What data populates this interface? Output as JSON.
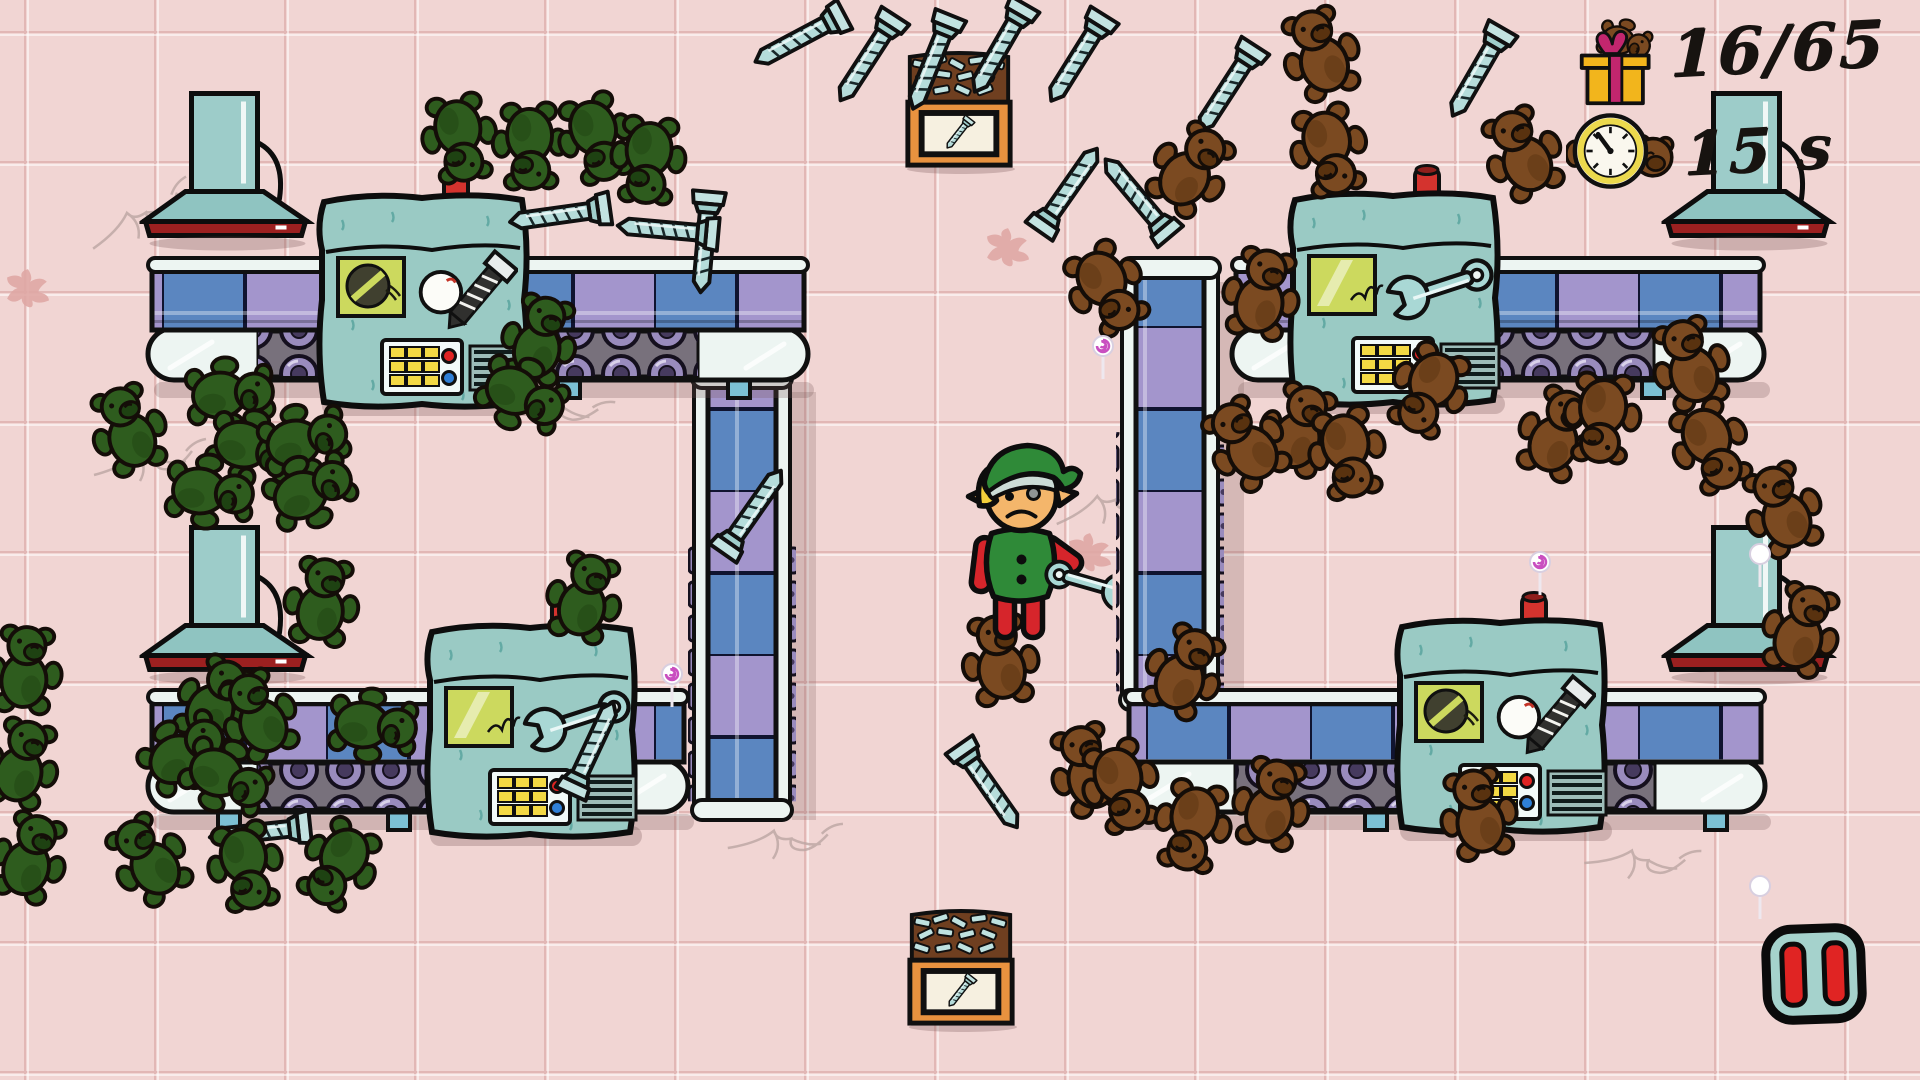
{
  "meta": {
    "screen_width": 1920,
    "screen_height": 1080,
    "scene": "toy-factory-level"
  },
  "hud": {
    "toys": {
      "icon": "gift-with-teddy",
      "counter": "16/65"
    },
    "timer": {
      "icon": "teddy-stopwatch",
      "value": "15 s"
    },
    "pause": {
      "kind": "pause-button"
    }
  },
  "colors": {
    "floor": "#f1d5d3",
    "floor_line": "#e2b7b5",
    "machine_teal": "#9acac4",
    "belt_blue": "#5b86c0",
    "belt_purple": "#a395cc",
    "frame_white": "#edf5f2",
    "roller_purple": "#998bbd",
    "roller_strip": "#78717c",
    "bear_brown": "#7b4a21",
    "bear_green": "#2e5c1e",
    "bolt_teal": "#b5dcda",
    "sign_yellow": "#ccd95e",
    "lever_red": "#d4332e",
    "pause_red": "#e02423",
    "bin_orange": "#e8923f",
    "hud_text": "#171310",
    "gift_yellow": "#f2b51c",
    "ribbon_magenta": "#c2266e",
    "watch_ring": "#ecd94d"
  },
  "entities": {
    "lamps": [
      [
        140,
        88
      ],
      [
        140,
        522
      ],
      [
        1662,
        88
      ],
      [
        1662,
        522
      ]
    ],
    "conveyors_v": [
      [
        694,
        378,
        432
      ],
      [
        1122,
        268,
        432
      ]
    ],
    "conveyors_h": [
      [
        148,
        266,
        660
      ],
      [
        1232,
        266,
        532
      ],
      [
        148,
        698,
        540
      ],
      [
        1125,
        698,
        640
      ]
    ],
    "machines": [
      [
        312,
        190,
        "screw"
      ],
      [
        1283,
        188,
        "wrench"
      ],
      [
        420,
        620,
        "wrench"
      ],
      [
        1390,
        615,
        "screw"
      ]
    ],
    "bins": [
      [
        900,
        48
      ],
      [
        902,
        906
      ]
    ],
    "elf": [
      1025,
      552
    ],
    "brown_bears": [
      [
        1320,
        52,
        -20
      ],
      [
        1330,
        152,
        165
      ],
      [
        1522,
        152,
        -25
      ],
      [
        1192,
        168,
        35
      ],
      [
        1108,
        290,
        150
      ],
      [
        1262,
        292,
        12
      ],
      [
        1690,
        362,
        -18
      ],
      [
        1428,
        392,
        -155
      ],
      [
        1300,
        428,
        18
      ],
      [
        1245,
        442,
        -35
      ],
      [
        1348,
        455,
        168
      ],
      [
        1558,
        432,
        22
      ],
      [
        1602,
        420,
        -175
      ],
      [
        1712,
        448,
        155
      ],
      [
        1782,
        508,
        -22
      ],
      [
        1802,
        628,
        18
      ],
      [
        1000,
        658,
        -8
      ],
      [
        1185,
        670,
        25
      ],
      [
        1088,
        768,
        -18
      ],
      [
        1122,
        788,
        162
      ],
      [
        1272,
        802,
        12
      ],
      [
        1192,
        828,
        -168
      ],
      [
        1478,
        812,
        -12
      ]
    ],
    "green_bears": [
      [
        460,
        140,
        170
      ],
      [
        530,
        148,
        178
      ],
      [
        597,
        140,
        162
      ],
      [
        648,
        162,
        185
      ],
      [
        540,
        338,
        15
      ],
      [
        524,
        396,
        115
      ],
      [
        128,
        428,
        -20
      ],
      [
        232,
        394,
        85
      ],
      [
        254,
        448,
        105
      ],
      [
        306,
        440,
        75
      ],
      [
        212,
        492,
        95
      ],
      [
        312,
        490,
        65
      ],
      [
        322,
        600,
        8
      ],
      [
        585,
        596,
        15
      ],
      [
        375,
        726,
        95
      ],
      [
        25,
        668,
        5
      ],
      [
        22,
        762,
        15
      ],
      [
        216,
        700,
        28
      ],
      [
        258,
        714,
        -25
      ],
      [
        186,
        752,
        55
      ],
      [
        228,
        778,
        115
      ],
      [
        30,
        856,
        18
      ],
      [
        148,
        858,
        -35
      ],
      [
        246,
        868,
        168
      ],
      [
        338,
        866,
        -150
      ]
    ],
    "bolts": [
      [
        800,
        38,
        62
      ],
      [
        868,
        58,
        33
      ],
      [
        932,
        62,
        22
      ],
      [
        1000,
        48,
        30
      ],
      [
        1078,
        58,
        32
      ],
      [
        1228,
        88,
        33
      ],
      [
        1478,
        72,
        30
      ],
      [
        560,
        215,
        82
      ],
      [
        705,
        242,
        5
      ],
      [
        668,
        230,
        95
      ],
      [
        1068,
        190,
        215
      ],
      [
        1138,
        198,
        140
      ],
      [
        752,
        512,
        215
      ],
      [
        592,
        748,
        205
      ],
      [
        260,
        832,
        84
      ],
      [
        988,
        786,
        325
      ]
    ],
    "swirls": [
      [
        1103,
        358,
        "#c94fc0"
      ],
      [
        672,
        686,
        "#c94fc0"
      ],
      [
        1540,
        574,
        "#c94fc0"
      ],
      [
        1760,
        566,
        "#ffffff"
      ],
      [
        1760,
        898,
        "#ffffff"
      ]
    ],
    "splats": [
      [
        28,
        288
      ],
      [
        1008,
        247
      ],
      [
        1090,
        552
      ]
    ],
    "cracks": [
      [
        160,
        460,
        0
      ],
      [
        565,
        408,
        18
      ],
      [
        1120,
        500,
        -8
      ],
      [
        795,
        840,
        6
      ],
      [
        1652,
        862,
        12
      ],
      [
        150,
        212,
        -20
      ]
    ]
  }
}
